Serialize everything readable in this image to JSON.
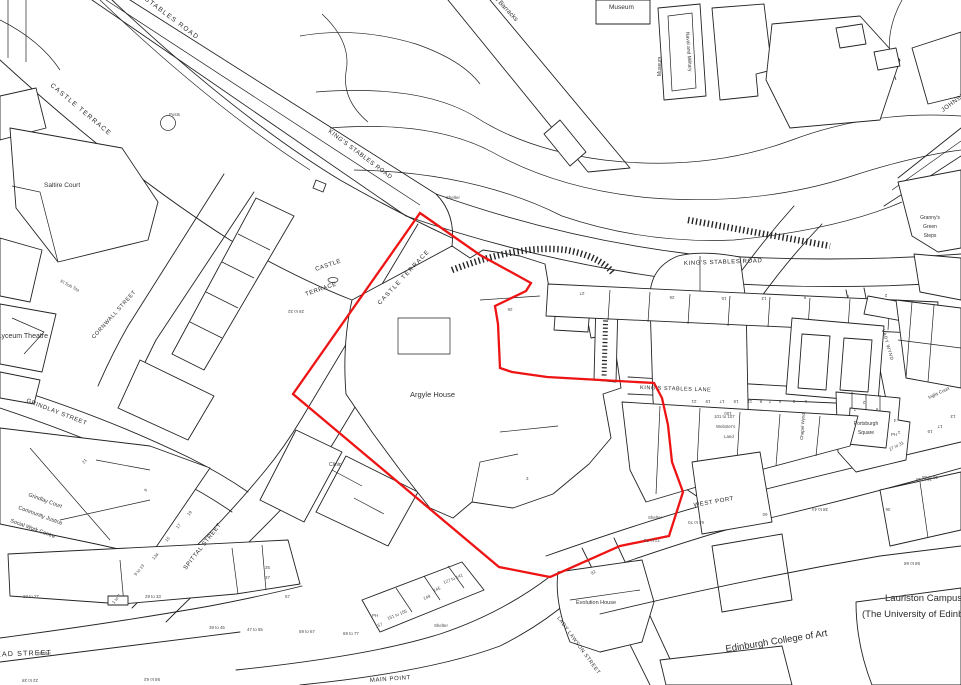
{
  "map_type": "site-location-plan",
  "colors": {
    "background": "#ffffff",
    "linework": "#232323",
    "site_boundary": "#ee1414"
  },
  "site_boundary": {
    "description": "red site outline around Argyle House",
    "points": "420,213 480,255 531,283 526,291 495,306 498,324 500,368 512,372 547,377 654,383 662,398 668,425 672,462 683,492 669,536 620,546 550,577 499,567 293,394"
  },
  "labels": {
    "streets": {
      "kings_stables_road": "KING'S STABLES ROAD",
      "castle_terrace": "CASTLE TERRACE",
      "castle_word": "CASTLE",
      "terrace_word": "TERRACE",
      "cornwall_street": "CORNWALL STREET",
      "grindlay_street": "GRINDLAY STREET",
      "spittal_street": "SPITTAL STREET",
      "kings_stables_lane": "KING'S STABLES LANE",
      "west_port": "WEST PORT",
      "lady_lawson_street": "LADY LAWSON STREET",
      "lady_wynd": "LADY WYND",
      "main_point": "MAIN POINT",
      "bread_street": "BREAD STREET",
      "johnston_terrace": "JOHNSTON TERRACE",
      "chapel_wynd": "Chapel Wynd"
    },
    "places": {
      "saltire_court": "Saltire Court",
      "museum": "Museum",
      "naval_and_military": "Naval and Military",
      "new_barracks": "New Barracks",
      "grannys_1": "Granny's",
      "grannys_2": "Green",
      "grannys_3": "Steps",
      "royal_lyceum": "Royal Lyceum Theatre",
      "argyle_house": "Argyle House",
      "clinic": "Clinic",
      "grindlay_court_1": "Grindlay Court",
      "grindlay_court_2": "Community Justice",
      "grindlay_court_3": "Social Work Centre",
      "portsburgh_1": "Portsburgh",
      "portsburgh_2": "Square",
      "inglis_court": "Inglis Court",
      "websters_1": "101 to 107",
      "websters_2": "Webster's",
      "websters_3": "Land",
      "evolution_house": "Evolution House",
      "eca": "Edinburgh College of Art",
      "lauriston_campus": "Lauriston Campus",
      "university": "(The University of Edinburgh)",
      "shelter": "Shelter",
      "posts": "Posts",
      "el_sub_sta": "El Sub Sta",
      "ph": "PH"
    },
    "numbers": {
      "n23_27": "23 to 27",
      "n29_33": "29 to 33",
      "n35": "35",
      "n37": "37",
      "n39_45": "39 to 45",
      "n47_55": "47 to 55",
      "n57": "57",
      "n59_67": "59 to 67",
      "n69_77": "69 to 77",
      "n1_7": "1 to 7",
      "n9_13": "9 to 13",
      "n13a": "13a",
      "n15": "15",
      "n17": "17",
      "n19": "19",
      "n21": "21",
      "n9": "9",
      "n157": "157",
      "n151_155": "151 to 155",
      "n149": "149",
      "n145": "145",
      "n127_141": "127 to 141",
      "n92": "92",
      "n3": "3",
      "n100": "100",
      "lane_21": "21",
      "lane_19": "19",
      "lane_17": "17",
      "lane_15": "15",
      "lane_11": "11",
      "lane_9": "9",
      "lane_7": "7",
      "lane_5": "5",
      "lane_3": "3",
      "lane_1": "1",
      "ksr_26": "26",
      "ksr_15": "15",
      "ksr_13": "13",
      "ksr_9": "9",
      "ksr_6": "6",
      "ksr_2": "2",
      "ah_26": "26",
      "ah_27": "27",
      "ct_29_32": "29 to 32",
      "wp_72_76": "72 to 76",
      "wp_62_70": "62 to 70",
      "wp_60": "60",
      "wp_38_44": "38 to 44",
      "wp_36": "36",
      "wp_30_38": "30 to 38",
      "wp_58_68": "58 to 68",
      "wp_27_31": "27 to 31",
      "wp_16_18": "16 to 18",
      "pb_2": "2",
      "pb_6": "6",
      "pb_4": "4",
      "pb_1": "1",
      "pb_7": "7",
      "ig_19": "19",
      "ig_17": "17",
      "ig_13": "13",
      "bs_22_28": "22 to 28",
      "bs_58_62": "58 to 62"
    }
  }
}
